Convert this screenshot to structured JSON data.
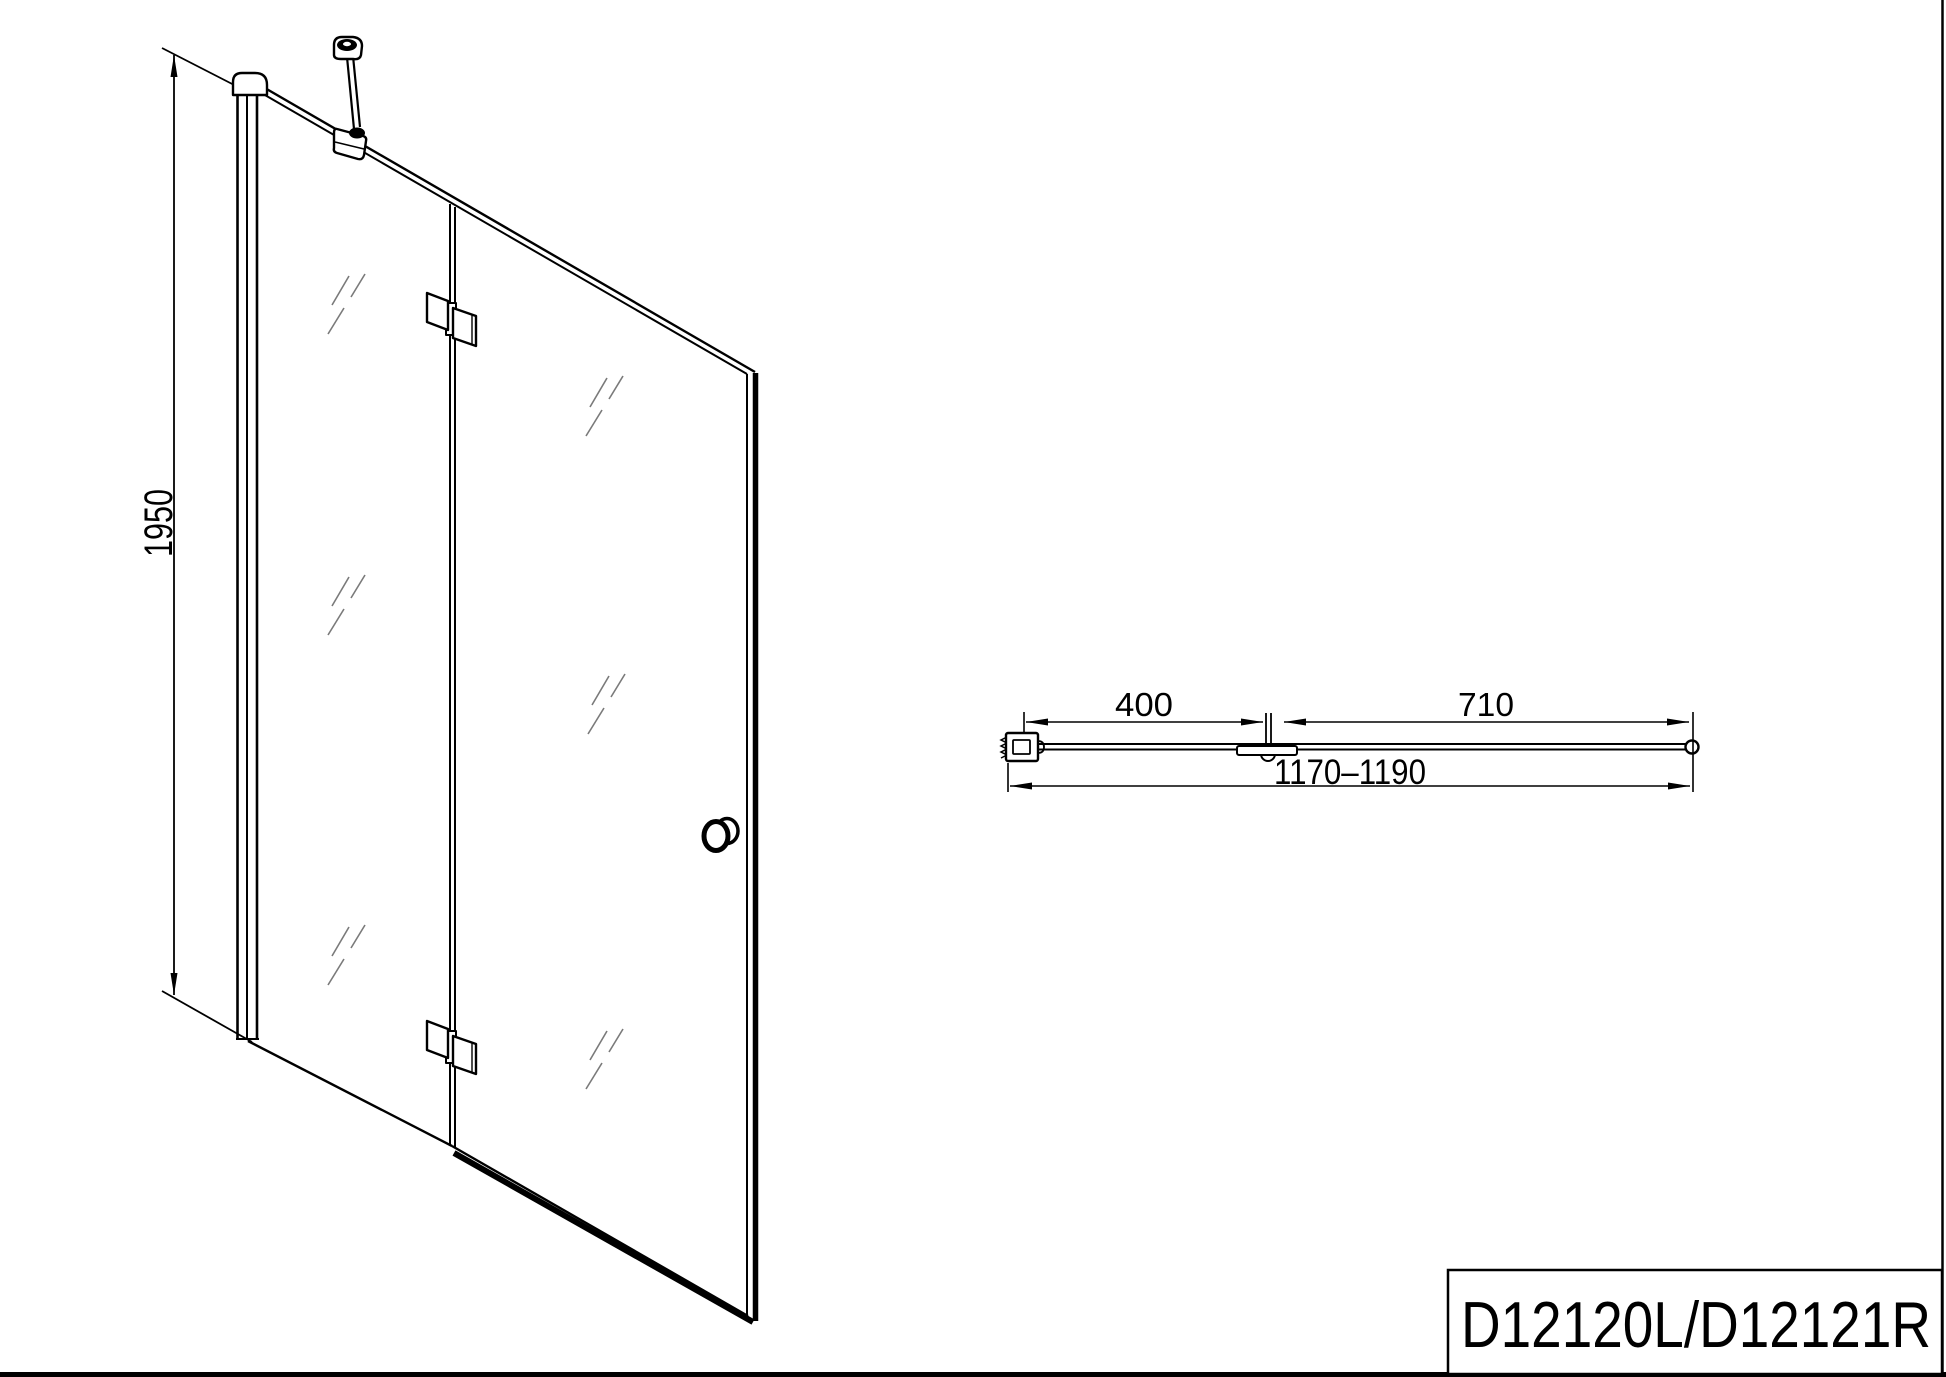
{
  "front_view": {
    "height_dimension": "1950"
  },
  "top_view": {
    "panel_width_dimension": "400",
    "door_width_dimension": "710",
    "total_width_dimension": "1170–1190"
  },
  "title_block": {
    "model_code": "D12120L/D12121R"
  },
  "colors": {
    "line": "#000000",
    "glass_mark": "#7a7a7a",
    "background": "#ffffff"
  }
}
